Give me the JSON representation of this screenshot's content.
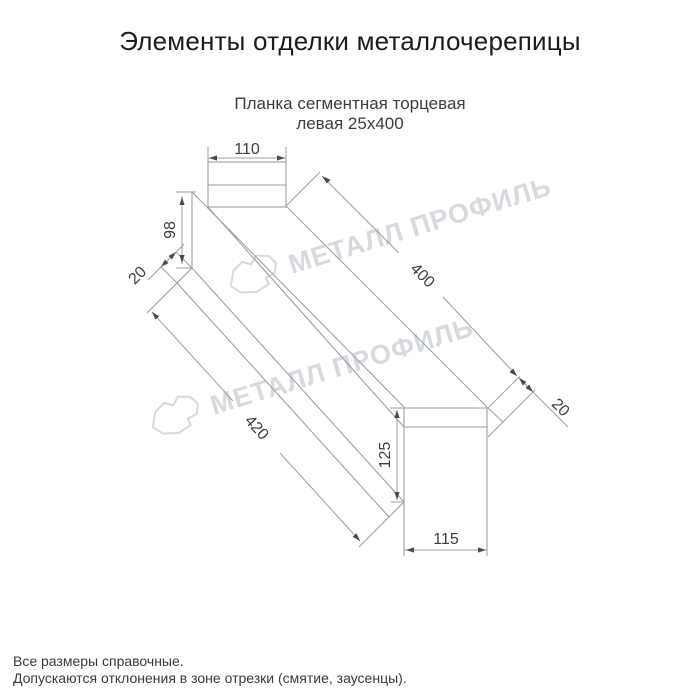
{
  "page": {
    "title": "Элементы отделки металлочерепицы"
  },
  "product": {
    "subtitle_line1": "Планка сегментная торцевая",
    "subtitle_line2": "левая 25х400"
  },
  "drawing": {
    "dimensions": {
      "top_flange_width": "110",
      "left_height": "98",
      "left_fold": "20",
      "face_length": "400",
      "bottom_length": "420",
      "right_fold": "20",
      "right_height": "125",
      "right_flange_width": "115"
    }
  },
  "watermark": {
    "brand": "МЕТАЛЛ ПРОФИЛЬ"
  },
  "footer": {
    "note1": "Все размеры справочные.",
    "note2": "Допускаются отклонения в зоне отрезки (смятие, заусенцы)."
  },
  "colors": {
    "title_text": "#1c1c1c",
    "subtitle_text": "#3c3c3c",
    "drawing_line": "#9ba1a7",
    "dimension_text": "#3d3d3d",
    "arrow": "#4a4a4a",
    "watermark": "#d6dade",
    "background": "#ffffff"
  }
}
